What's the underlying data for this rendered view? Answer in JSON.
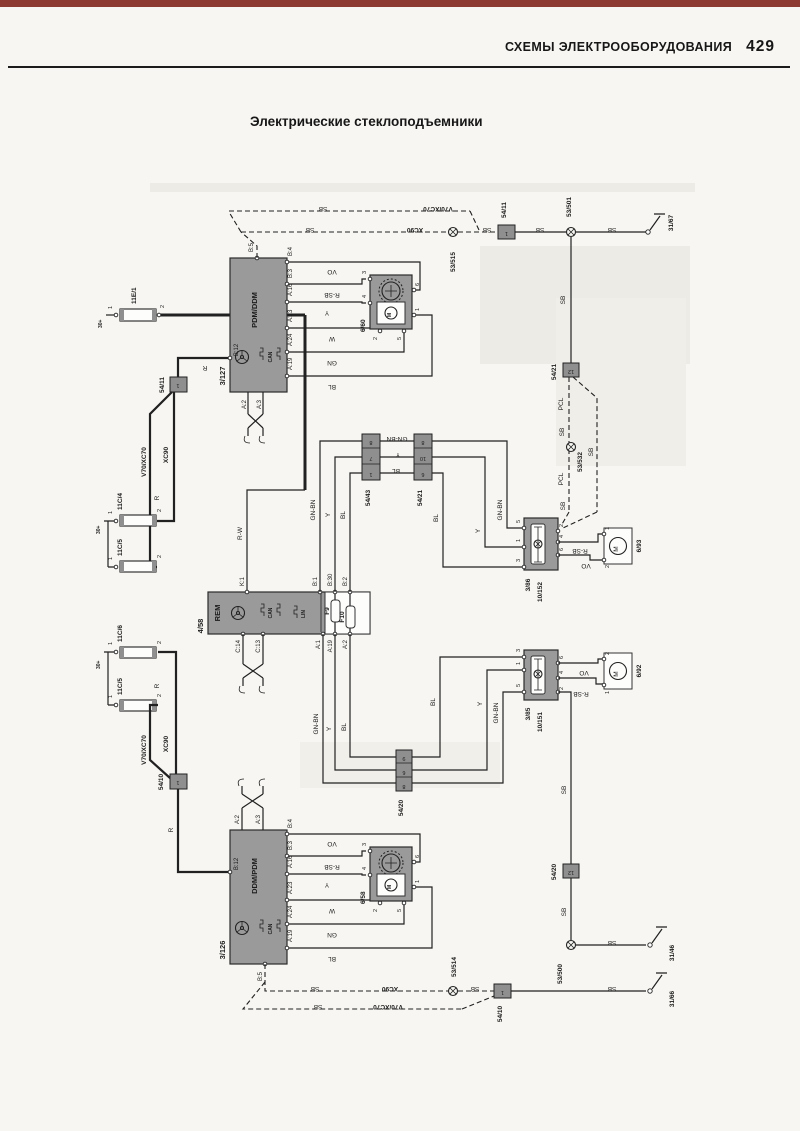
{
  "page": {
    "header": "СХЕМЫ ЭЛЕКТРООБОРУДОВАНИЯ",
    "page_number": "429",
    "title": "Электрические стеклоподъемники"
  },
  "wire": {
    "sb": "SB",
    "r": "R",
    "rw": "R-W",
    "vo": "VO",
    "rsb": "R-SB",
    "y": "Y",
    "w": "W",
    "gn": "GN",
    "bl": "BL",
    "gnbn": "GN-BN",
    "pcl": "PCL"
  },
  "variant": {
    "v70": "V70/XC70",
    "xc90": "XC90"
  },
  "power": {
    "plus30": "30+",
    "f11e1": "11E/1",
    "f11c4": "11C/4",
    "f11c5": "11C/5",
    "f11c6": "11C/6"
  },
  "num": {
    "n1": "1",
    "n2": "2",
    "n3": "3",
    "n4": "4",
    "n5": "5",
    "n6": "6",
    "n7": "7",
    "n8": "8",
    "n9": "9",
    "n10": "10",
    "n12": "12"
  },
  "pins": {
    "b12": "B:12",
    "b5": "B:5",
    "b4": "B:4",
    "b3": "B:3",
    "a16": "A:16",
    "a23": "A:23",
    "a24": "A:24",
    "a19": "A:19",
    "a2": "A:2",
    "a3": "A:3",
    "a1": "A:1",
    "k1": "K:1",
    "b1": "B:1",
    "b30": "B:30",
    "b2": "B:2",
    "c14": "C:14",
    "c13": "C:13"
  },
  "bus": {
    "can": "CAN",
    "lin": "LIN"
  },
  "modules": {
    "pdm": {
      "name": "PDM/DDM",
      "id": "3/127"
    },
    "rem": {
      "name": "REM",
      "id": "4/58",
      "f9": "F9",
      "f10": "F10"
    },
    "ddm": {
      "name": "DDM/PDM",
      "id": "3/126"
    }
  },
  "units": {
    "u660": "6/60",
    "u658": "6/58",
    "m693": "6/93",
    "m692": "6/92",
    "motor_letter": "M",
    "s386": "3/86",
    "s386b": "10/152",
    "s385": "3/85",
    "s385b": "10/151"
  },
  "conn": {
    "c5411": "54/11",
    "c5410": "54/10",
    "c5421": "54/21",
    "c5420": "54/20",
    "c5443": "54/43"
  },
  "joint": {
    "j53515": "53/515",
    "j53501": "53/501",
    "j53532": "53/532",
    "j53500": "53/500",
    "j53514": "53/514"
  },
  "gnd": {
    "g3167": "31/67",
    "g3146": "31/46",
    "g3166": "31/66"
  }
}
